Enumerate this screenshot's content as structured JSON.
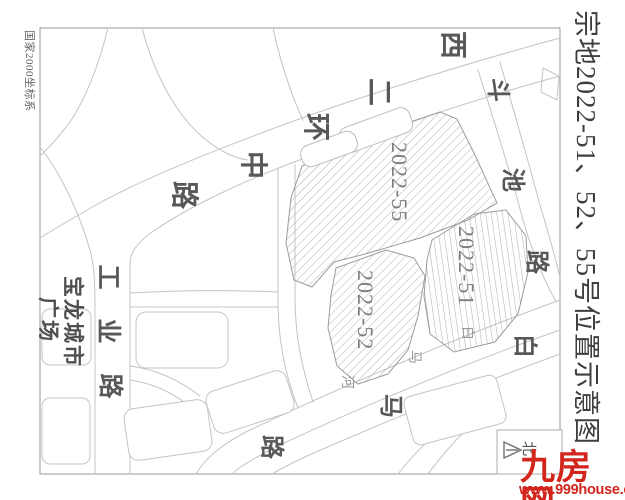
{
  "frame": {
    "coord_system_label": "国家2000坐标系",
    "title": "宗地2022-51、52、55号位置示意图"
  },
  "roads": {
    "xierhuanzhong": {
      "name": "西二环中路",
      "chars": [
        "西",
        "二",
        "环",
        "中",
        "路"
      ]
    },
    "douchi": {
      "name": "斗池路",
      "chars": [
        "斗",
        "池",
        "路"
      ]
    },
    "gongye": {
      "name": "工业路",
      "chars": [
        "工",
        "业",
        "路"
      ]
    },
    "baima_road": {
      "name": "白马路",
      "chars": [
        "白",
        "马",
        "路"
      ]
    }
  },
  "water": {
    "baima_river": {
      "name": "白马河",
      "chars": [
        "白",
        "马",
        "河"
      ]
    }
  },
  "landmarks": {
    "baolong_plaza": {
      "name": "宝龙城市广场",
      "line1": "宝龙城市",
      "line2": "广场"
    }
  },
  "parcels": {
    "p55": {
      "label": "2022-55"
    },
    "p51": {
      "label": "2022-51"
    },
    "p52": {
      "label": "2022-52"
    }
  },
  "compass": {
    "north_label": "北"
  },
  "watermark": {
    "logo": "九房网",
    "url": "www.999house.com"
  },
  "colors": {
    "map_line": "#c4c4c4",
    "road_text": "#585858",
    "hatch": "#b2b2b2",
    "watermark_red": "#d2251b"
  }
}
